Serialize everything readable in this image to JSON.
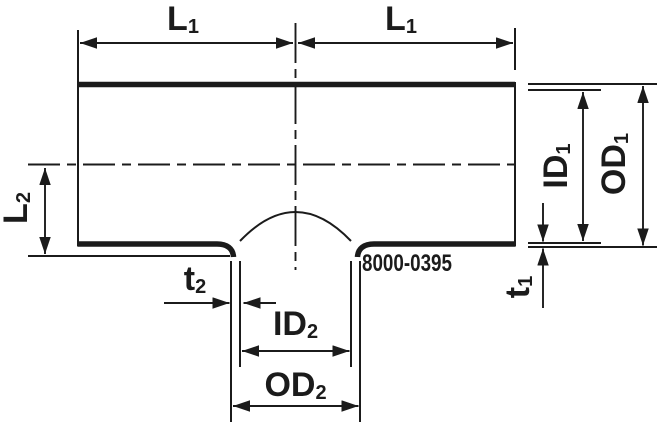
{
  "part_number": "8000-0395",
  "colors": {
    "line": "#1b1b1b",
    "background": "#ffffff"
  },
  "labels": {
    "l1_left": {
      "text": "L",
      "sub": "1"
    },
    "l1_right": {
      "text": "L",
      "sub": "1"
    },
    "l2": {
      "text": "L",
      "sub": "2"
    },
    "id1": {
      "text": "ID",
      "sub": "1"
    },
    "od1": {
      "text": "OD",
      "sub": "1"
    },
    "t1": {
      "text": "t",
      "sub": "1"
    },
    "t2": {
      "text": "t",
      "sub": "2"
    },
    "id2": {
      "text": "ID",
      "sub": "2"
    },
    "od2": {
      "text": "OD",
      "sub": "2"
    }
  }
}
